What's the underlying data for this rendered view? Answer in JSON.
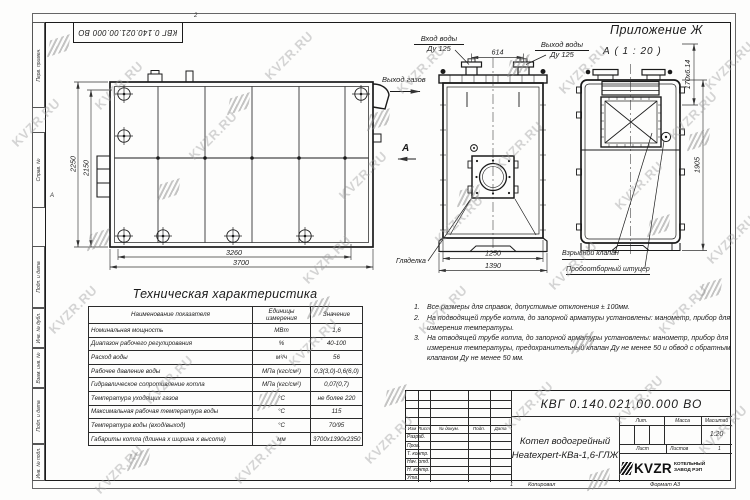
{
  "page": {
    "appendix": "Приложение Ж",
    "doc_number": "КВГ 0.140.021.00.000 ВО",
    "zone_top": "2",
    "zone_left": "А",
    "watermark": "KVZR.RU"
  },
  "margin_columns": [
    {
      "label": "Перв. примен."
    },
    {
      "label": "Справ. №"
    },
    {
      "label": "Подп. и дата"
    },
    {
      "label": "Инв. № дубл."
    },
    {
      "label": "Взам. инв. №"
    },
    {
      "label": "Подп. и дата"
    },
    {
      "label": "Инв. № подл."
    }
  ],
  "drawing": {
    "view_a_label": "А ( 1 : 20 )",
    "labels": {
      "water_inlet_line1": "Вход воды",
      "water_inlet_line2": "Ду 125",
      "water_outlet_line1": "Выход воды",
      "water_outlet_line2": "Ду 125",
      "gas_outlet": "Выход газов",
      "view_arrow": "А",
      "sight_glass": "Гляделка",
      "explosion_valve": "Взрывной клапан",
      "sampling_fitting": "Пробоотборный штуцер"
    },
    "dims": {
      "side_height_outer": "2250",
      "side_height_inner": "2150",
      "side_width_inner": "3260",
      "side_width_outer": "3700",
      "nozzle_spacing": "614",
      "front_width_inner": "1250",
      "front_width_outer": "1390",
      "rear_height": "1905",
      "top_row_pitch": "170х6.14"
    }
  },
  "spec_table": {
    "title": "Техническая характеристика",
    "headers": [
      "Наименование показателя",
      "Единицы измерения",
      "Значение"
    ],
    "rows": [
      [
        "Номинальная мощность",
        "МВт",
        "1,6"
      ],
      [
        "Диапазон рабочего регулирования",
        "%",
        "40-100"
      ],
      [
        "Расход воды",
        "м³/ч",
        "56"
      ],
      [
        "Рабочее давление воды",
        "МПа (кгс/см²)",
        "0,3(3,0)-0,6(6,0)"
      ],
      [
        "Гидравлическое сопротивление котла",
        "МПа (кгс/см²)",
        "0,07(0,7)"
      ],
      [
        "Температура уходящих газов",
        "°С",
        "не более 220"
      ],
      [
        "Максимальная рабочая температура воды",
        "°С",
        "115"
      ],
      [
        "Температура воды (вход/выход)",
        "°С",
        "70/95"
      ],
      [
        "Габариты котла (длинна х ширина х высота)",
        "мм",
        "3700х1390х2350"
      ]
    ]
  },
  "notes": [
    {
      "num": "1.",
      "text": "Все размеры для справок, допустимые отклонения ± 100мм."
    },
    {
      "num": "2.",
      "text": "На подводящей трубе котла, до запорной арматуры установлены: манометр, прибор для измерения температуры."
    },
    {
      "num": "3.",
      "text": "На отводящей трубе котла, до запорной арматуры установлены: манометр, прибор для измерения температуры, предохранительный клапан Ду не менее 50 и обвод с обратным клапаном Ду не менее 50 мм."
    }
  ],
  "title_block": {
    "doc_number": "КВГ 0.140.021.00.000 ВО",
    "product_line1": "Котел водогрейный",
    "product_line2": "Heatexpert-КВа-1,6-ГЛЖ",
    "rev_headers": [
      "Изм",
      "Лист",
      "№ докум.",
      "Подп.",
      "Дата"
    ],
    "role_rows": [
      "Разраб.",
      "Пров.",
      "Т. контр.",
      "Нач. отд.",
      "Н. контр.",
      "Утв."
    ],
    "lit_label": "Лит.",
    "mass_label": "Масса",
    "scale_label": "Масштаб",
    "scale_value": "1:20",
    "sheet_label": "Лист",
    "sheets_label": "Листов",
    "sheets_value": "1",
    "logo_text": "KVZR",
    "company_line1": "КОТЕЛЬНЫЙ",
    "company_line2": "ЗАВОД РЭП",
    "copied_num": "1",
    "copied_label": "Копировал",
    "format_label": "Формат А3"
  }
}
